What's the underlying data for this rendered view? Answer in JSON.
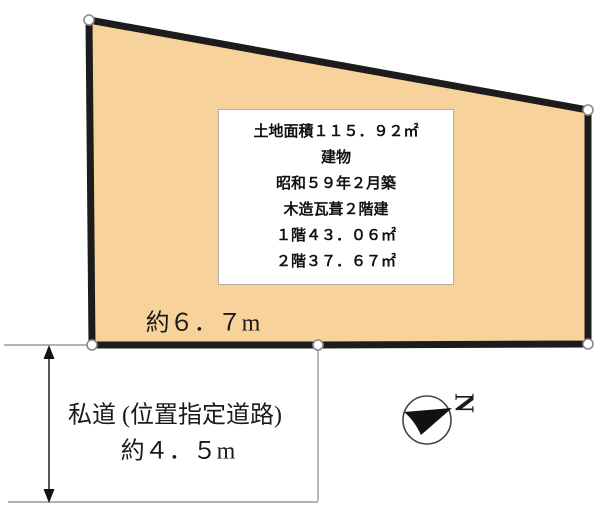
{
  "page": {
    "background": "#ffffff"
  },
  "land": {
    "fill": "#f8d29b",
    "border_color": "#1c1c1c",
    "width_label": "約６．７m",
    "info_box": {
      "lines": [
        "土地面積１１５．９２㎡",
        "建物",
        "昭和５９年２月築",
        "木造瓦葺２階建",
        "１階４３．０６㎡",
        "２階３７．６７㎡"
      ]
    }
  },
  "road": {
    "name": "私道 (位置指定道路)",
    "width_label": "約４．５m"
  },
  "compass": {
    "north_label": "N"
  }
}
